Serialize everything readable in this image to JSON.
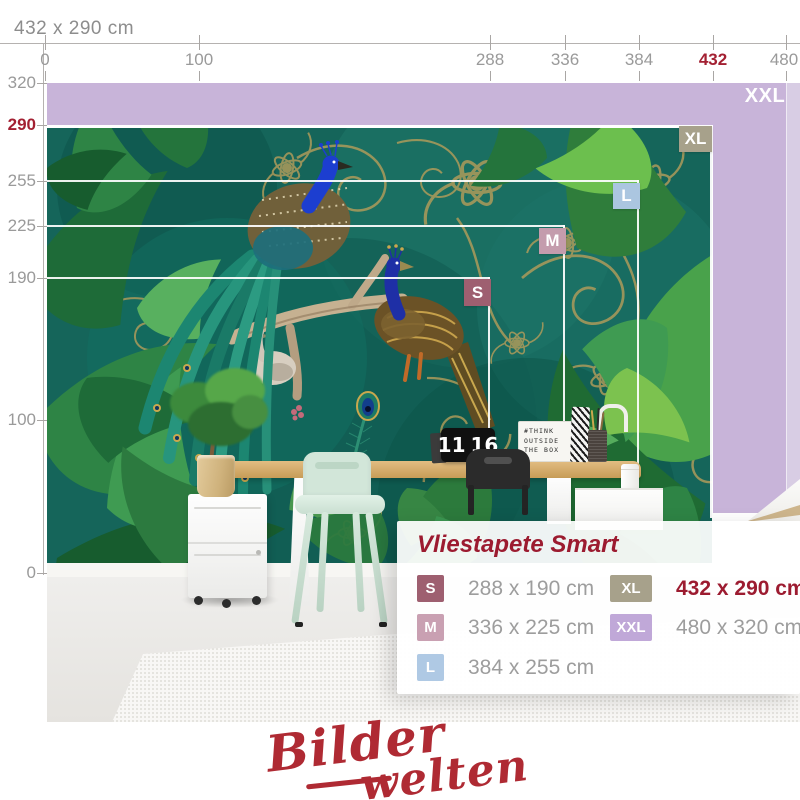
{
  "header": {
    "dimensions_label": "432 x 290 cm"
  },
  "ruler_top": {
    "ticks": [
      {
        "label": "0",
        "x": 45,
        "highlight": false
      },
      {
        "label": "100",
        "x": 199,
        "highlight": false
      },
      {
        "label": "288",
        "x": 490,
        "highlight": false
      },
      {
        "label": "336",
        "x": 565,
        "highlight": false
      },
      {
        "label": "384",
        "x": 639,
        "highlight": false
      },
      {
        "label": "432",
        "x": 713,
        "highlight": true
      },
      {
        "label": "480",
        "x": 786,
        "highlight": false
      }
    ]
  },
  "ruler_left": {
    "ticks": [
      {
        "label": "320",
        "y": 83,
        "highlight": false
      },
      {
        "label": "290",
        "y": 125,
        "highlight": true
      },
      {
        "label": "255",
        "y": 181,
        "highlight": false
      },
      {
        "label": "225",
        "y": 226,
        "highlight": false
      },
      {
        "label": "190",
        "y": 278,
        "highlight": false
      },
      {
        "label": "100",
        "y": 420,
        "highlight": false
      },
      {
        "label": "0",
        "y": 573,
        "highlight": false
      }
    ]
  },
  "size_overlay": {
    "badges": [
      {
        "code": "XXL",
        "color": "transparent",
        "text_only": true
      },
      {
        "code": "XL",
        "color": "#a7a18b"
      },
      {
        "code": "L",
        "color": "#abc6e0"
      },
      {
        "code": "M",
        "color": "#c49cad"
      },
      {
        "code": "S",
        "color": "#9e5f70"
      }
    ]
  },
  "room": {
    "clock": {
      "hours": "11",
      "minutes": "16"
    },
    "lightbox_lines": [
      "#THINK",
      "OUTSIDE",
      "THE BOX"
    ]
  },
  "panel": {
    "title": "Vliestapete Smart",
    "sizes": [
      {
        "code": "S",
        "dims": "288 x 190 cm",
        "color": "#9e5f70",
        "selected": false
      },
      {
        "code": "M",
        "dims": "336 x 225 cm",
        "color": "#c9a0b2",
        "selected": false
      },
      {
        "code": "L",
        "dims": "384 x 255 cm",
        "color": "#afc9e4",
        "selected": false
      },
      {
        "code": "XL",
        "dims": "432 x 290 cm",
        "color": "#a7a18b",
        "selected": true
      },
      {
        "code": "XXL",
        "dims": "480 x 320 cm",
        "color": "#c0a8d8",
        "selected": false
      }
    ]
  },
  "logo": {
    "line1": "Bilder",
    "line2": "welten"
  },
  "colors": {
    "accent_red": "#9c1b30",
    "ruler_gray": "#9a9a9a",
    "xxl_zone_purple": "#c8b4d9",
    "xxl_zone_purple_light": "#d8cde4",
    "mural_teal": "#15655a",
    "mural_gold": "#b79e5a",
    "desk_wood": "#c79c57",
    "mint_chair": "#d2e6d9"
  }
}
